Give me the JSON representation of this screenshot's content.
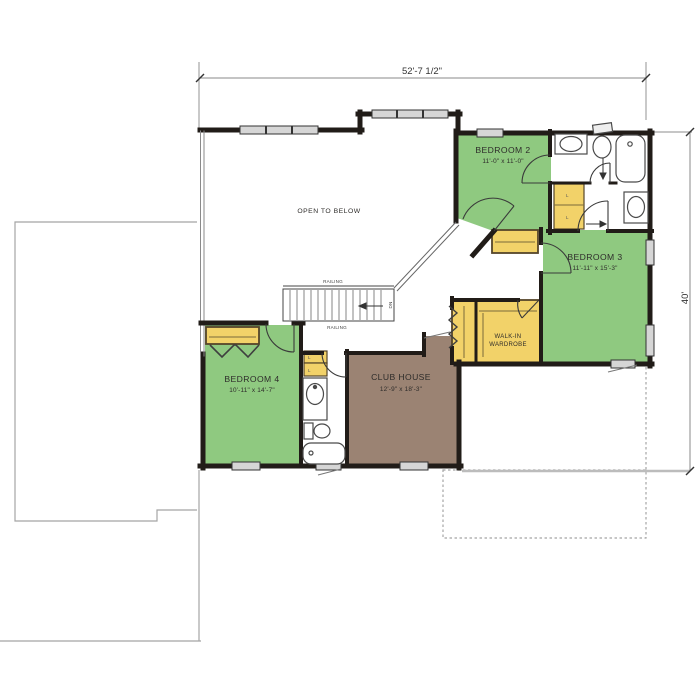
{
  "plan": {
    "dimension_top": "52'-7 1/2\"",
    "dimension_right": "40'",
    "rooms": {
      "bedroom2": {
        "name": "BEDROOM 2",
        "size": "11'-0\" x 11'-0\""
      },
      "bedroom3": {
        "name": "BEDROOM 3",
        "size": "11'-11\" x 15'-3\""
      },
      "bedroom4": {
        "name": "BEDROOM 4",
        "size": "10'-11\" x 14'-7\""
      },
      "clubhouse": {
        "name": "CLUB HOUSE",
        "size": "12'-9\" x 18'-3\""
      },
      "wardrobe": {
        "line1": "WALK-IN",
        "line2": "WARDROBE"
      }
    },
    "labels": {
      "open_to_below": "OPEN TO BELOW",
      "railing": "RAILING",
      "down": "DN",
      "linen": "L"
    },
    "colors": {
      "bedroom_green": "#8fc980",
      "clubhouse_brown": "#9b8373",
      "closet_yellow": "#f2d269",
      "wall_black": "#211c18",
      "window_gray": "#d6d6d6",
      "outline_gray": "#a5a5a5",
      "fixture_stroke": "#4a4a4a"
    }
  }
}
